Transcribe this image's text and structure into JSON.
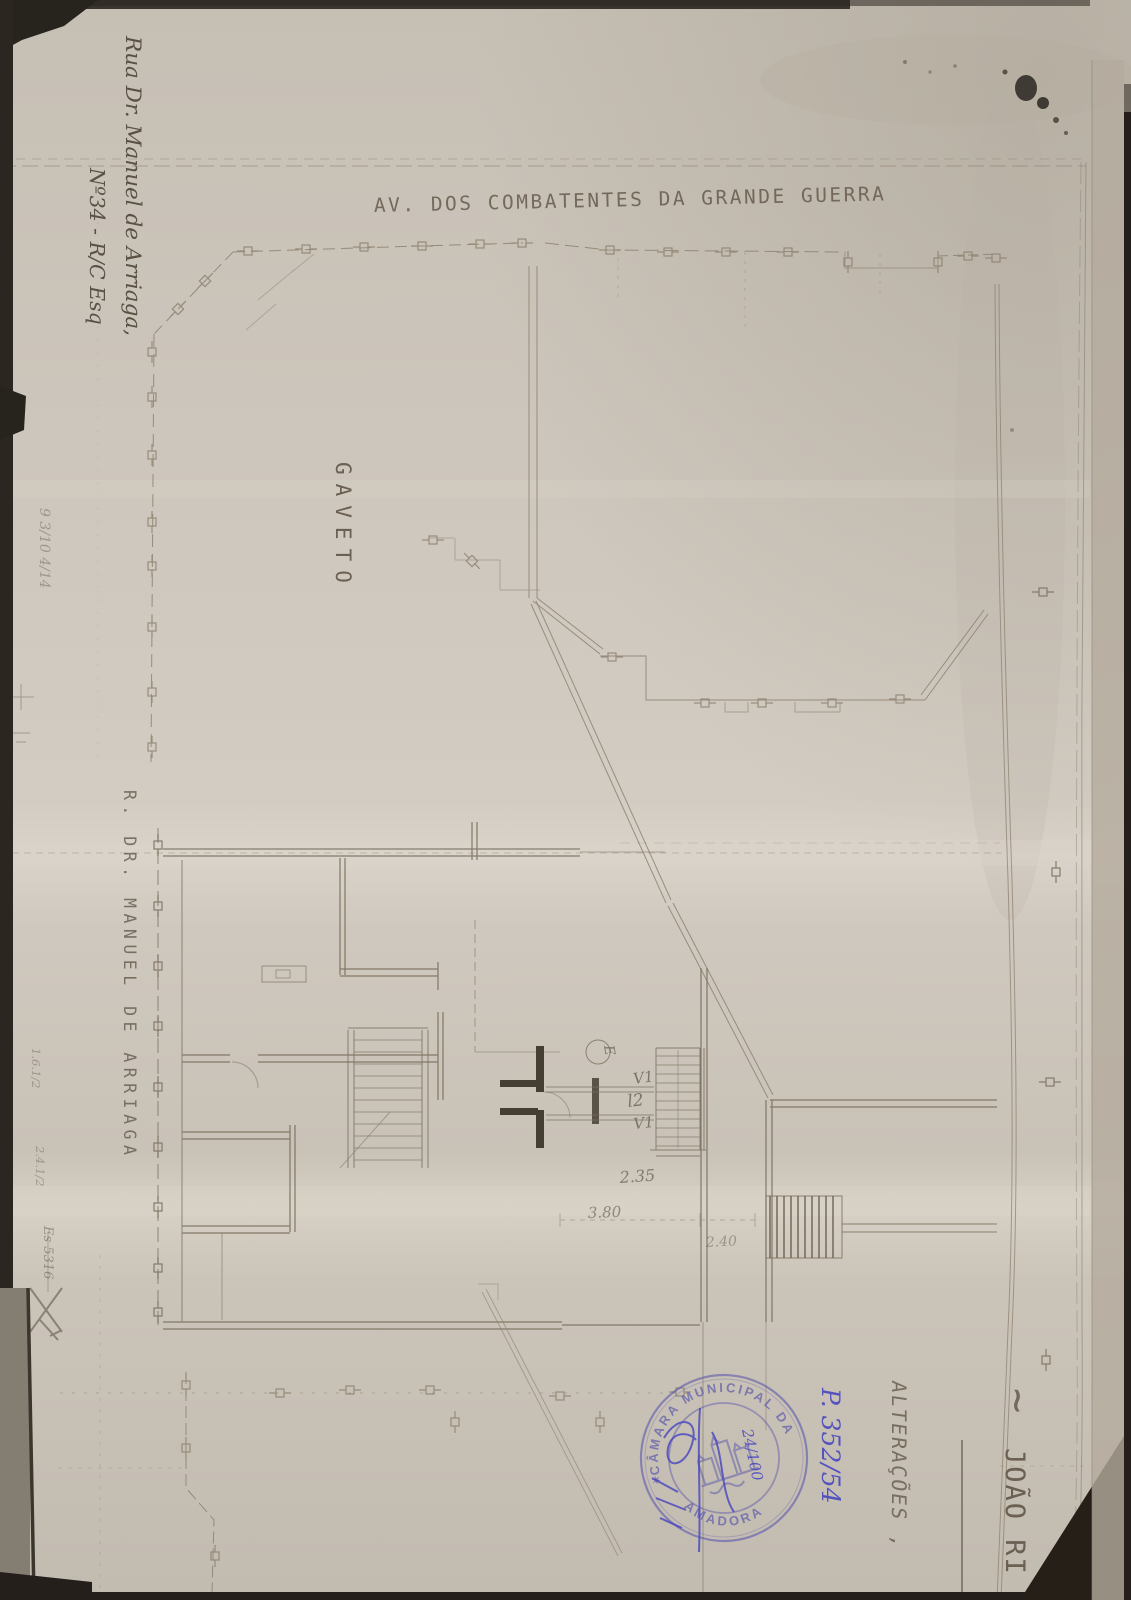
{
  "plan": {
    "street_top_label": "AV. DOS COMBATENTES DA GRANDE GUERRA",
    "corner_label": "GAVETO",
    "street_left_label": "R. DR. MANUEL DE ARRIAGA",
    "entry_label": "E",
    "window_label_upper": "V1",
    "door_label": "l2",
    "window_label_lower": "V1",
    "dim_a": "2.35",
    "dim_b": "3.80",
    "dim_c": "2.40"
  },
  "annotations": {
    "address_line1": "Rua Dr. Manuel de Arriaga,",
    "address_line2": "Nº34 - R/C Esq",
    "applicant_tilde": "~",
    "applicant_name": "JOÃO RI",
    "subject": "ALTERAÇÕES ,",
    "pencil_top": "9 3/10 4/14",
    "pencil_note_1": "1.6.1/2",
    "pencil_note_2": "2.4.1/2",
    "pencil_note_3": "Es 5316"
  },
  "stamp": {
    "ring_top": "CÂMARA MUNICIPAL DA",
    "ring_bottom": "AMADORA",
    "separator": "✶",
    "process_number": "P. 352/54",
    "scale_note": "24/100",
    "ink_color": "#5b58ac"
  },
  "colors": {
    "paper": "#cdc6bc",
    "pencil": "#8a7e6c",
    "ink_blue": "#4745c0",
    "scan_edge": "#241f1a"
  }
}
